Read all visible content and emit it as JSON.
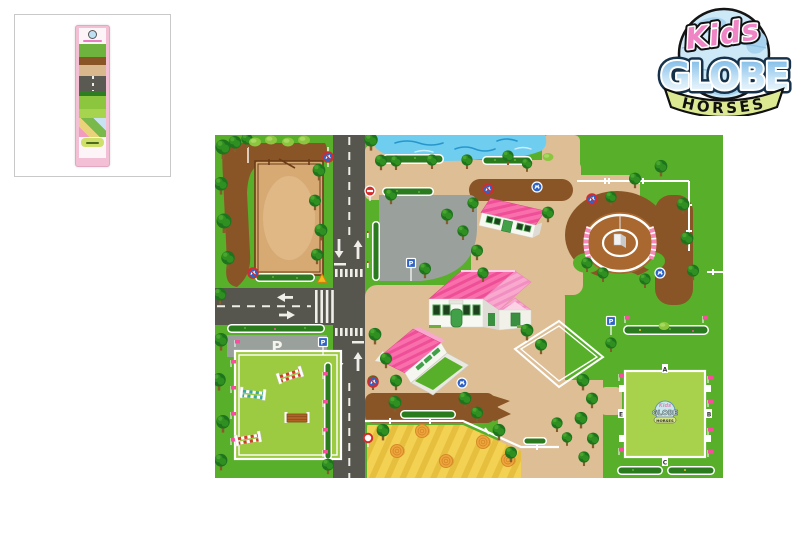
{
  "brand": {
    "kids": "Kids",
    "globe": "GLOBE",
    "horses": "HORSES"
  },
  "playmat": {
    "parking_label": "P",
    "parking_painted_label": "P",
    "dressage_letters": {
      "top": "A",
      "bottom": "C",
      "left": "E",
      "right": "B"
    },
    "watermark": {
      "kids": "Kids",
      "globe": "GLOBE",
      "horses": "HORSES"
    }
  },
  "colors": {
    "grass": "#58b02a",
    "arena_green": "#9cca40",
    "dressage_green": "#a9d24c",
    "path_tan": "#debe94",
    "road_gray": "#56554e",
    "parking_gray": "#9aa09c",
    "dirt_brown": "#8a5526",
    "paddock_sand": "#d7aa74",
    "pond_blue": "#6fcdf0",
    "roof_pink": "#f86fac",
    "roof_pink_light": "#f9a9cd",
    "hay_yellow": "#f3d153",
    "bale_orange": "#efa63c",
    "flag_pink": "#f74f9e",
    "sign_blue": "#2f63c4",
    "sign_red": "#d42b2b",
    "hedge_green": "#2a7a1e",
    "logo_pink": "#ef85c4",
    "logo_blue": "#cde9f8",
    "banner_green": "#dde992"
  }
}
